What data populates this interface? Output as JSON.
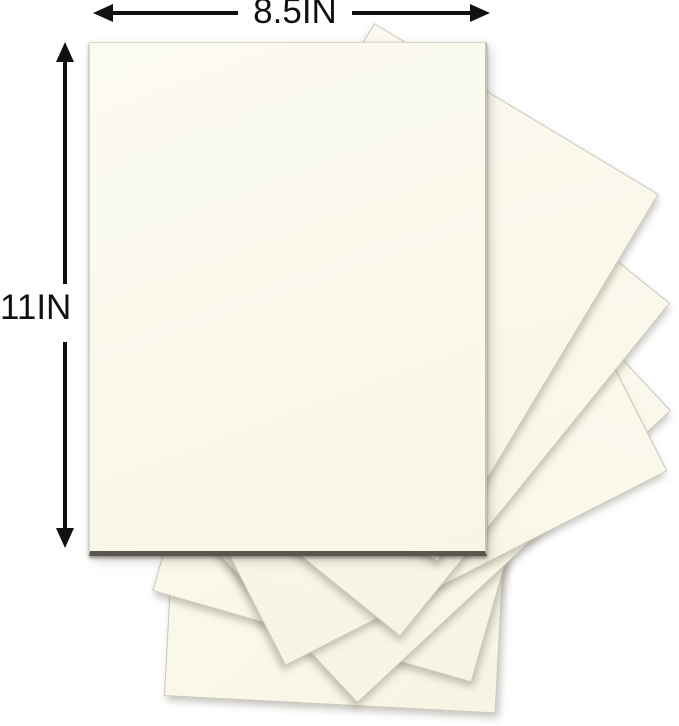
{
  "product_image": {
    "width_label": "8.5IN",
    "height_label": "11IN",
    "sheet_count_visible": 7,
    "colors": {
      "paper": "#FAF8EA",
      "paper_edge": "#C9C7BB",
      "main_sheet_bottom_edge": "#5A554D",
      "arrow": "#111111",
      "background": "#FFFFFF"
    }
  }
}
